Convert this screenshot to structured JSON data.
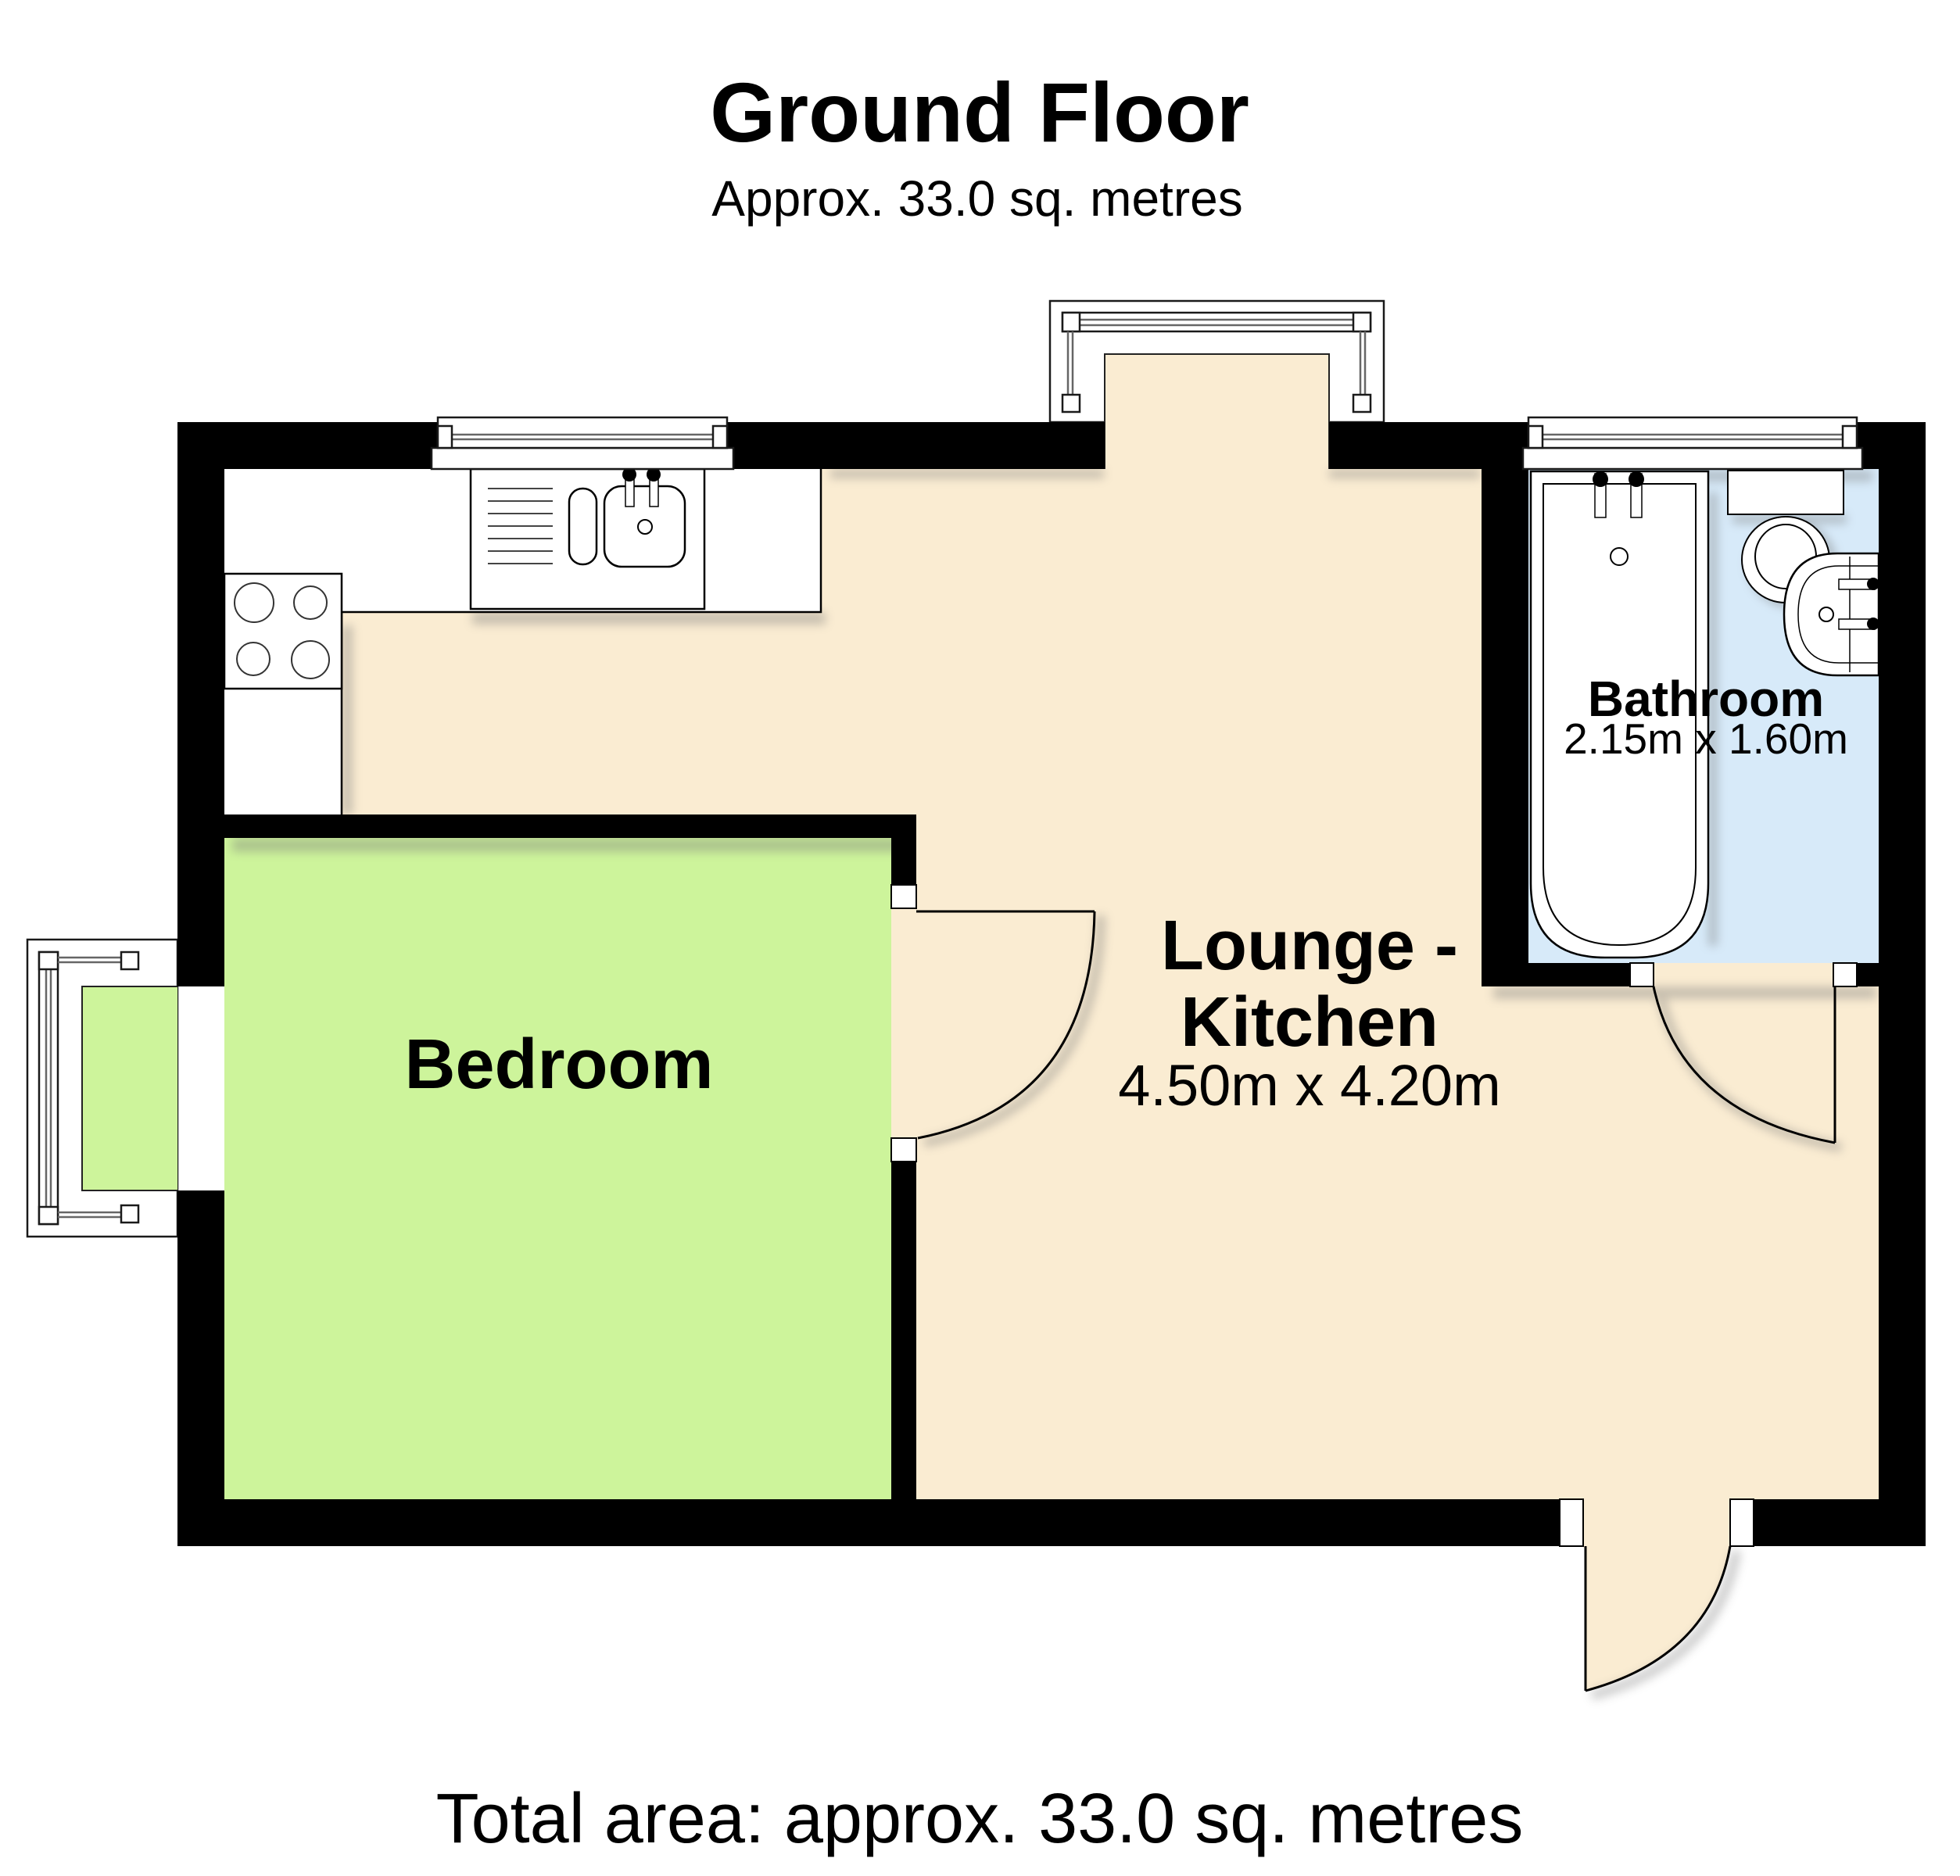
{
  "page": {
    "title": "Ground Floor",
    "subtitle": "Approx. 33.0 sq. metres",
    "footer": "Total area: approx. 33.0 sq. metres"
  },
  "rooms": {
    "bedroom": {
      "label": "Bedroom"
    },
    "lounge": {
      "label_line1": "Lounge -",
      "label_line2": "Kitchen",
      "dimensions": "4.50m x 4.20m"
    },
    "bathroom": {
      "label": "Bathroom",
      "dimensions": "2.15m x 1.60m"
    }
  },
  "fixtures": {
    "kitchen": [
      "kitchen-sink",
      "hob"
    ],
    "bathroom": [
      "bathtub",
      "toilet",
      "wash-basin"
    ]
  },
  "colors": {
    "lounge_floor": "#FAECD2",
    "bedroom_floor": "#CDF49B",
    "bathroom_floor": "#D7EAF9",
    "wall": "#000000",
    "shadow": "#777777"
  }
}
